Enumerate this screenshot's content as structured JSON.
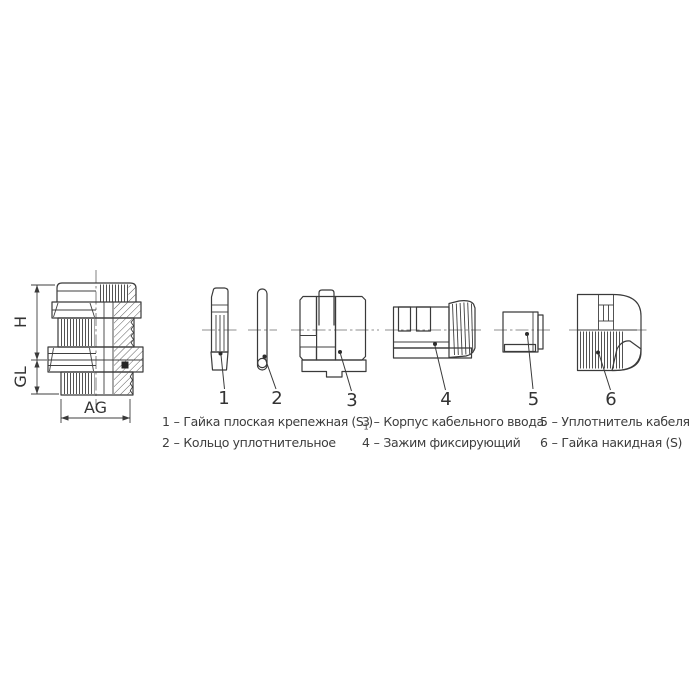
{
  "page": {
    "background": "#ffffff"
  },
  "drawing": {
    "line_color": "#3a3a3a",
    "dim_labels": {
      "height": "H",
      "gland_length": "GL",
      "thread": "AG"
    },
    "part_numbers": [
      "1",
      "2",
      "3",
      "4",
      "5",
      "6"
    ]
  },
  "legend": {
    "separator": "–",
    "columns": [
      {
        "items": [
          {
            "num": "1",
            "label": "Гайка плоская крепежная (S",
            "sub": "1",
            "suffix": ")"
          },
          {
            "num": "2",
            "label": "Кольцо уплотнительное",
            "sub": "",
            "suffix": ""
          }
        ]
      },
      {
        "items": [
          {
            "num": "3",
            "label": "Корпус кабельного ввода",
            "sub": "",
            "suffix": ""
          },
          {
            "num": "4",
            "label": "Зажим фиксирующий",
            "sub": "",
            "suffix": ""
          }
        ]
      },
      {
        "items": [
          {
            "num": "5",
            "label": "Уплотнитель кабеля",
            "sub": "",
            "suffix": ""
          },
          {
            "num": "6",
            "label": "Гайка накидная (S)",
            "sub": "",
            "suffix": ""
          }
        ]
      }
    ]
  }
}
